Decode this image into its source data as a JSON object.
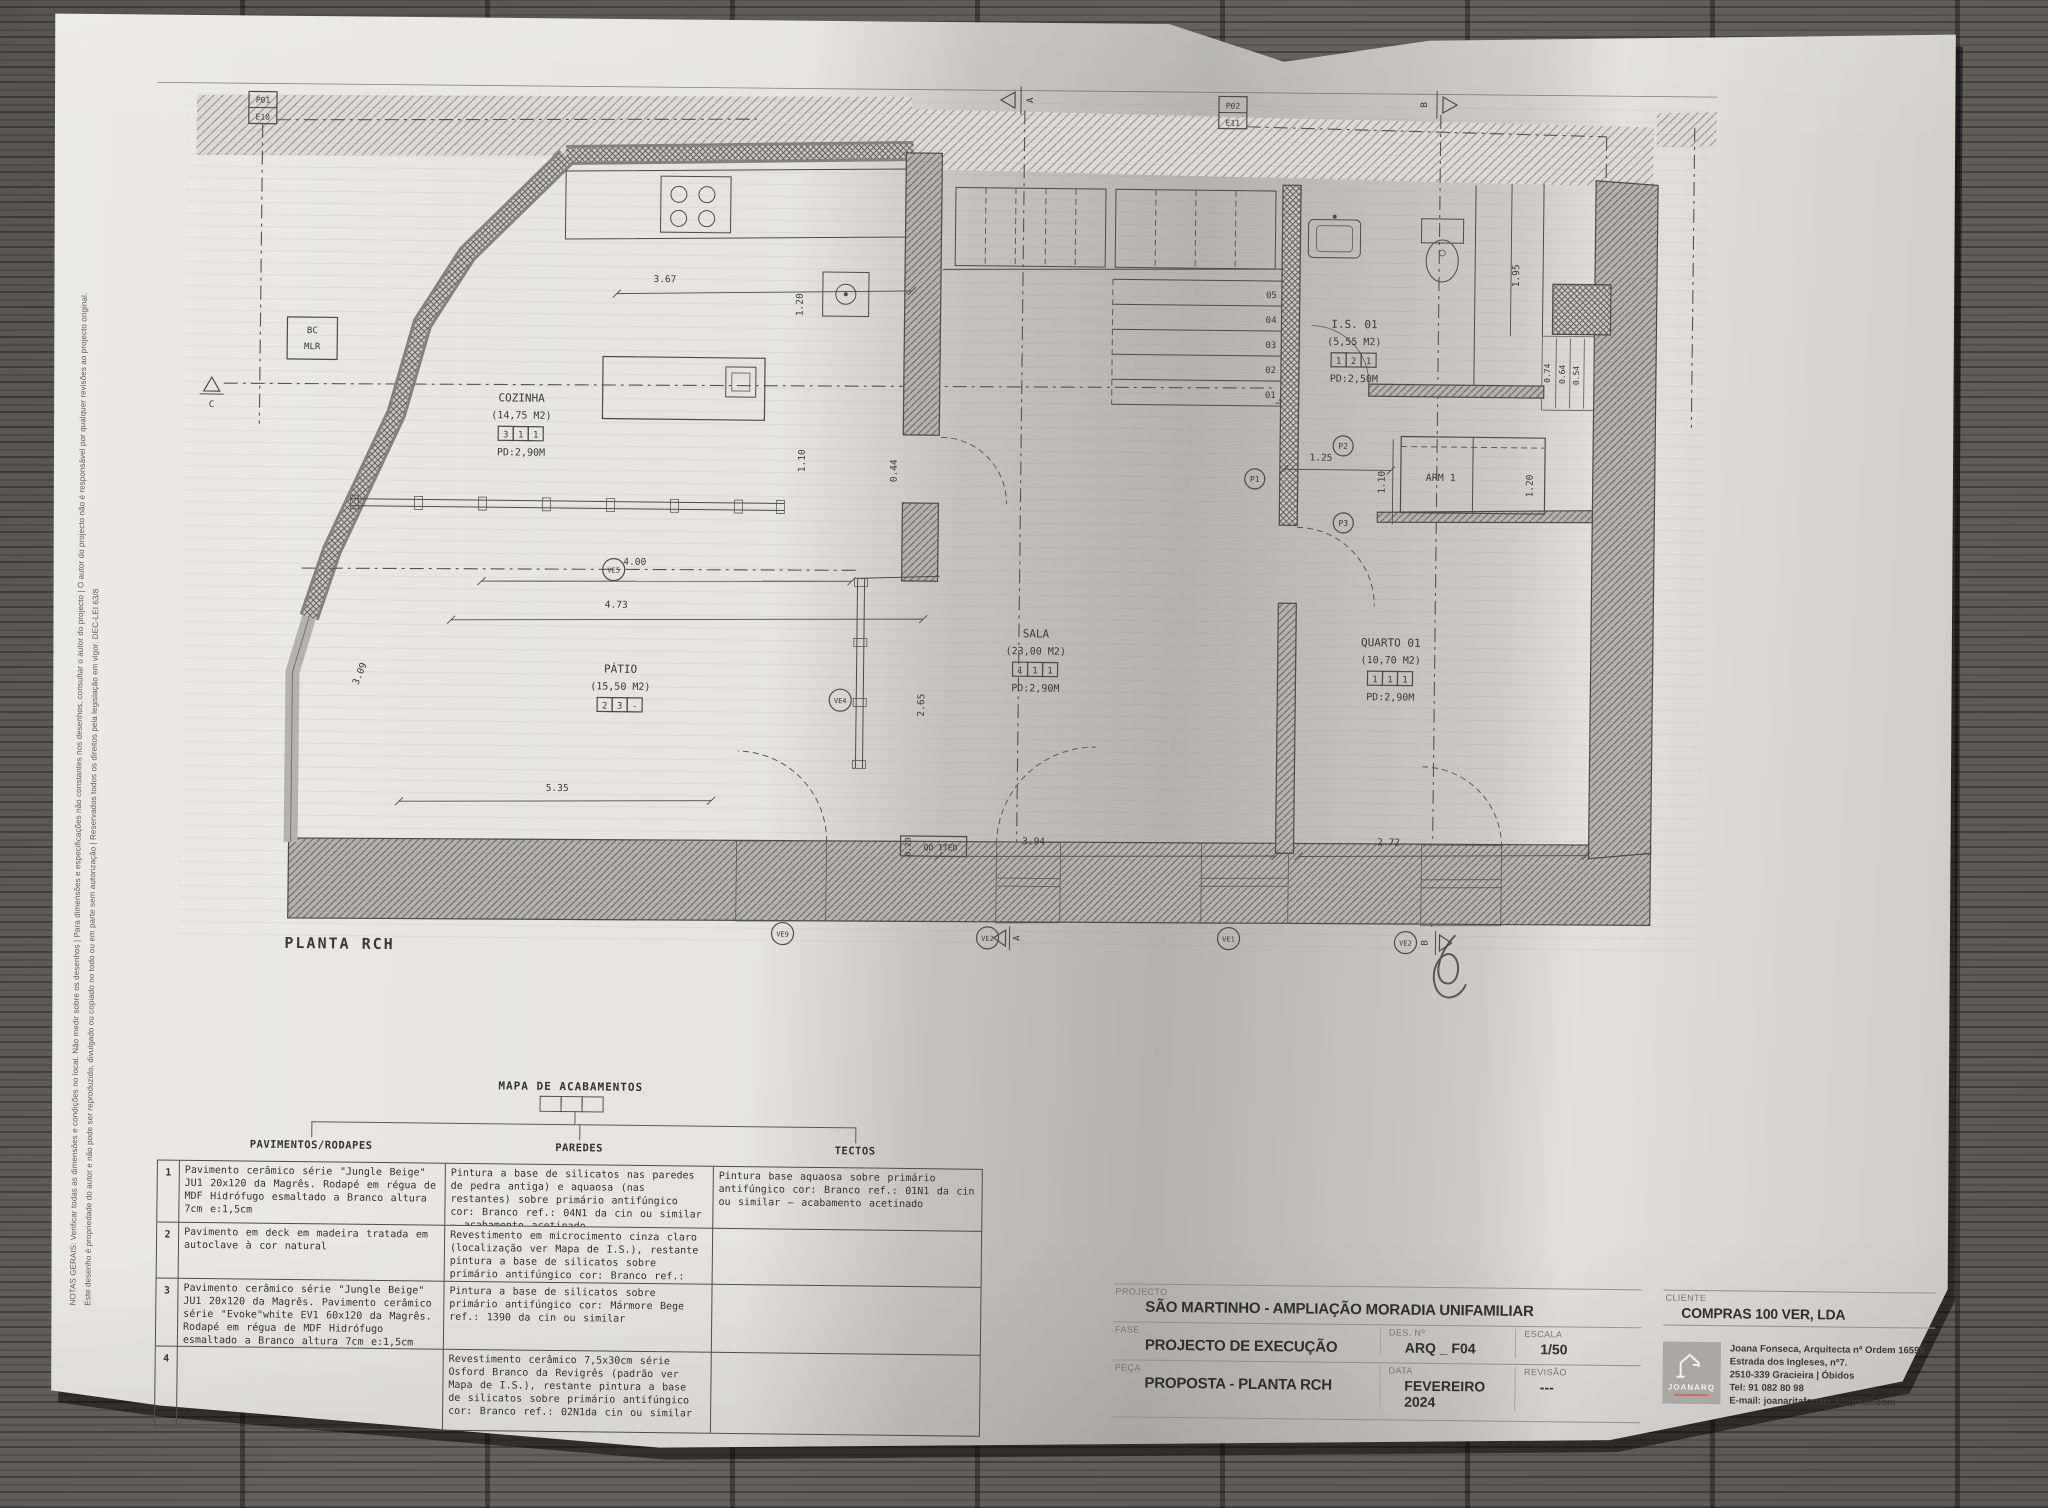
{
  "notes": {
    "line1": "NOTAS GERAIS: Verificar todas as dimensões e condições no local. Não medir sobre os desenhos | Para dimensões e especificações não constantes nos desenhos, consultar o autor do projecto | O autor do projecto não é responsável por qualquer revisões ao projecto original.",
    "line2": "Este desenho é propriedade do autor e não pode ser reproduzido, divulgado ou copiado no todo ou em parte sem autorização | Reservados todos os direitos pela legislação em vigor. DEC-LEI 63/8"
  },
  "plan": {
    "title": "PLANTA RCH",
    "rooms": [
      {
        "name": "COZINHA",
        "area": "(14,75 M2)",
        "codes": [
          "3",
          "1",
          "1"
        ],
        "pd": "PD:2,90M"
      },
      {
        "name": "PÁTIO",
        "area": "(15,50 M2)",
        "codes": [
          "2",
          "3",
          "-"
        ],
        "pd": ""
      },
      {
        "name": "SALA",
        "area": "(23,00 M2)",
        "codes": [
          "1",
          "1",
          "1"
        ],
        "pd": "PD:2,90M"
      },
      {
        "name": "QUARTO 01",
        "area": "(10,70 M2)",
        "codes": [
          "1",
          "1",
          "1"
        ],
        "pd": "PD:2,90M"
      },
      {
        "name": "I.S. 01",
        "area": "(5,55 M2)",
        "codes": [
          "1",
          "2",
          "1"
        ],
        "pd": "PD:2,50M"
      }
    ],
    "labels": {
      "arm": "ARM 1",
      "bc": "BC",
      "mlr": "MLR",
      "qd": "QD ITED"
    },
    "refs": {
      "p01": "P01",
      "e10": "E10",
      "p02": "P02",
      "e11": "E11"
    },
    "sections": {
      "a": "A",
      "b": "B",
      "c": "C"
    },
    "stairs": [
      "05",
      "04",
      "03",
      "02",
      "01"
    ],
    "markers": {
      "ve9": "VE9",
      "ve2a": "VE2",
      "ve1": "VE1",
      "ve2b": "VE2",
      "ve4": "VE4",
      "ve5": "VE5",
      "p1": "P1",
      "p2": "P2",
      "p3": "P3"
    },
    "dims": {
      "d367": "3.67",
      "d120": "1.20",
      "d110": "1.10",
      "d400": "4.00",
      "d473": "4.73",
      "d265": "2.65",
      "d309": "3.09",
      "d535": "5.35",
      "d044": "0.44",
      "d394": "3.94",
      "d272": "2.72",
      "d195": "1.95",
      "d074": "0.74",
      "d064": "0.64",
      "d054": "0.54",
      "d125": "1.25",
      "d110c": "1.10",
      "d120c": "1.20",
      "d020": "0.20"
    }
  },
  "finish_table": {
    "title": "MAPA DE ACABAMENTOS",
    "columns": [
      "PAVIMENTOS/RODAPES",
      "PAREDES",
      "TECTOS"
    ],
    "rows": [
      {
        "num": "1",
        "pavimentos": "Pavimento cerâmico série \"Jungle Beige\" JU1 20x120 da Magrês. Rodapé em régua de MDF Hidrófugo esmaltado a Branco altura 7cm e:1,5cm",
        "paredes": "Pintura a base de silicatos nas paredes de pedra antiga) e aquaosa (nas restantes) sobre primário antifúngico cor: Branco ref.: 04N1 da cin ou similar – acabamento acetinado",
        "tectos": "Pintura base aquaosa sobre primário antifúngico cor: Branco ref.: 01N1 da cin ou similar – acabamento acetinado"
      },
      {
        "num": "2",
        "pavimentos": "Pavimento em deck em madeira tratada em autoclave à cor natural",
        "paredes": "Revestimento em microcimento cinza claro (localização ver Mapa de I.S.), restante pintura a base de silicatos sobre primário antifúngico cor: Branco ref.: 02N1da cin ou similar",
        "tectos": ""
      },
      {
        "num": "3",
        "pavimentos": "Pavimento cerâmico série \"Jungle Beige\" JU1 20x120 da Magrês. Pavimento cerâmico série \"Evoke\"white EV1 60x120 da Magrês. Rodapé em régua de MDF Hidrófugo esmaltado a Branco altura 7cm e:1,5cm",
        "paredes": "Pintura a base de silicatos sobre primário antifúngico cor: Mármore Bege ref.: 1390 da cin ou similar",
        "tectos": ""
      },
      {
        "num": "4",
        "pavimentos": "",
        "paredes": "Revestimento cerâmico 7,5x30cm série Osford Branco da Revigrês (padrão ver Mapa de I.S.), restante pintura a base de silicatos sobre primário antifúngico cor: Branco ref.: 02N1da cin ou similar",
        "tectos": ""
      }
    ]
  },
  "title_block": {
    "projecto_label": "PROJECTO",
    "projecto": "SÃO MARTINHO  -  AMPLIAÇÃO  MORADIA UNIFAMILIAR",
    "fase_label": "FASE",
    "fase": "PROJECTO DE EXECUÇÃO",
    "des_label": "DES. Nº",
    "des": "ARQ _ F04",
    "escala_label": "ESCALA",
    "escala": "1/50",
    "peca_label": "PEÇA",
    "peca": "PROPOSTA - PLANTA RCH",
    "data_label": "DATA",
    "data": "FEVEREIRO 2024",
    "revisao_label": "REVISÃO",
    "revisao": "---",
    "cliente_label": "CLIENTE",
    "cliente": "COMPRAS 100 VER, LDA",
    "logo": "JOANARQ",
    "architect": [
      "Joana Fonseca, Arquitecta nº Ordem 16595",
      "Estrada dos Ingleses, nº7.",
      "2510-339 Gracieira | Óbidos",
      "Tel: 91 082 80 98",
      "E-mail: joanaritafonseca@gmail.com"
    ]
  }
}
